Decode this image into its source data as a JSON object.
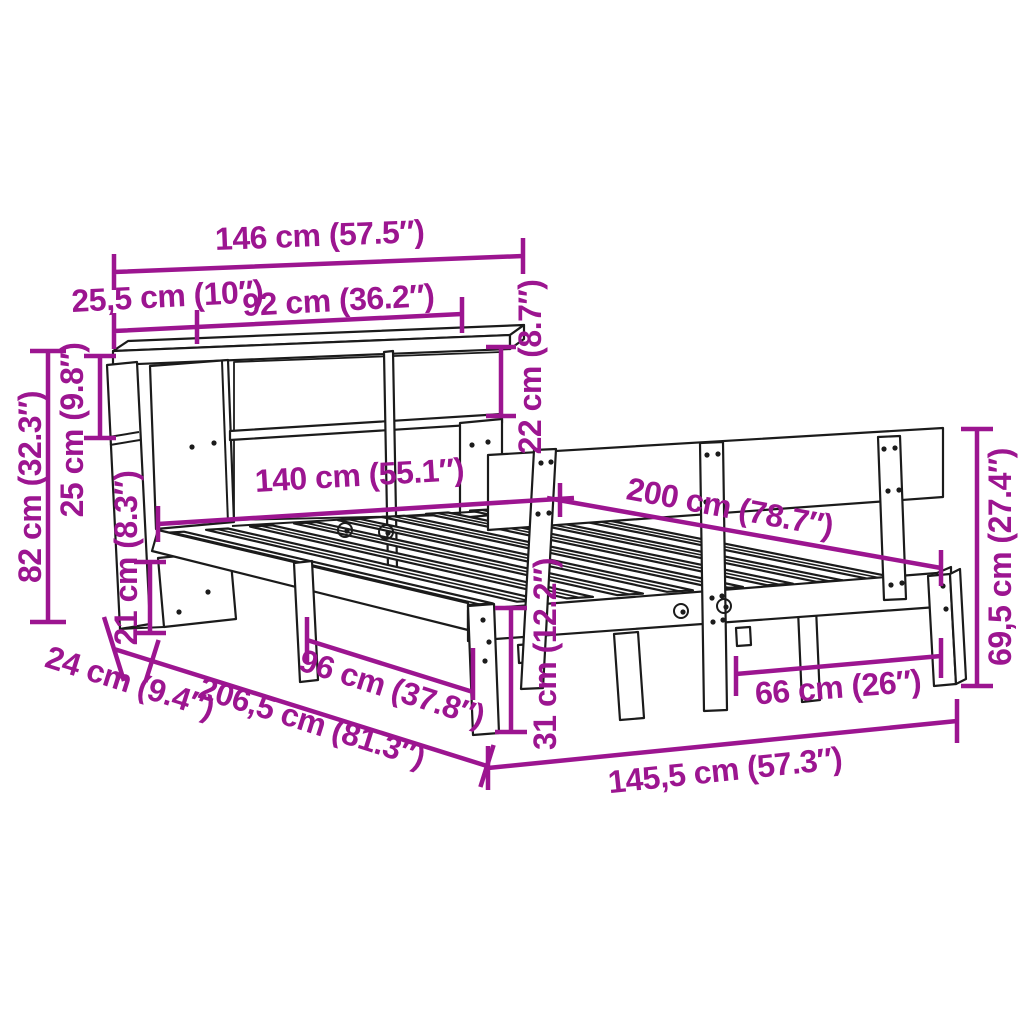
{
  "diagram": {
    "type": "product-dimension-diagram",
    "subject": "bed frame with bookcase headboard and slatted base",
    "colors": {
      "dimension_annotation": "#9C1590",
      "line_art": "#1b1b1b",
      "background": "#ffffff"
    },
    "dims": {
      "bookcase_width": "146 cm (57.5″)",
      "left_section_width": "25,5 cm (10″)",
      "shelf_opening_width": "92 cm (36.2″)",
      "top_shelf_height": "22 cm (8.7″)",
      "bookcase_height": "82 cm (32.3″)",
      "left_shelf_height": "25 cm (9.8″)",
      "bottom_clearance": "21 cm (8.3″)",
      "bed_width": "140 cm (55.1″)",
      "bed_length": "200 cm (78.7″)",
      "headboard_height": "69,5 cm (27.4″)",
      "foot_leg_spacing": "66 cm (26″)",
      "total_width": "145,5 cm (57.3″)",
      "bookcase_depth": "24 cm (9.4″)",
      "total_length": "206,5 cm (81.3″)",
      "side_leg_spacing": "96 cm (37.8″)",
      "frame_height": "31 cm (12.2″)"
    }
  }
}
